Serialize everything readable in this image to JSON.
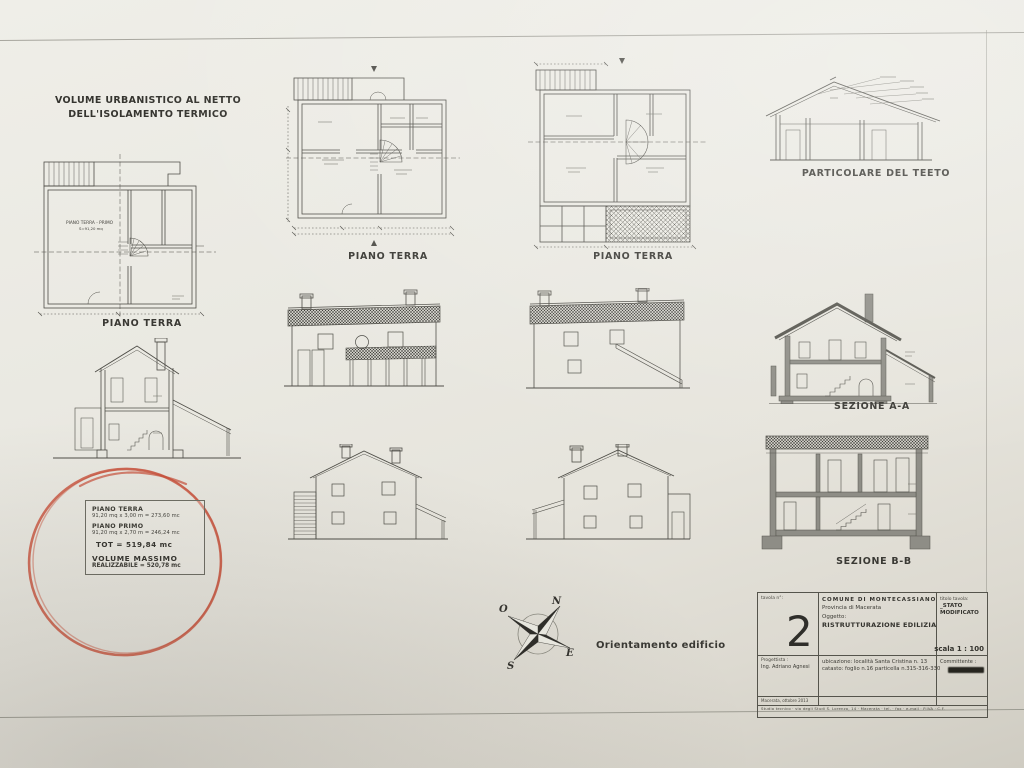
{
  "sheet": {
    "heading_line1": "VOLUME URBANISTICO AL NETTO",
    "heading_line2": "DELL'ISOLAMENTO TERMICO",
    "orientation_label": "Orientamento edificio"
  },
  "drawings": {
    "plan1": {
      "caption": "PIANO TERRA",
      "label1": "PIANO TERRA - PRIMO",
      "label2": "S=91,20 mq"
    },
    "plan2": {
      "caption": "PIANO TERRA"
    },
    "plan3": {
      "caption": "PIANO TERRA"
    },
    "roof_detail": {
      "caption": "PARTICOLARE DEL TEETO"
    },
    "section_a": {
      "caption": "SEZIONE A-A"
    },
    "section_b": {
      "caption": "SEZIONE B-B"
    }
  },
  "volume_note": {
    "piano_terra_label": "PIANO TERRA",
    "piano_terra_calc": "91,20 mq x 3,00 m = 273,60 mc",
    "piano_primo_label": "PIANO PRIMO",
    "piano_primo_calc": "91,20 mq x 2,70 m = 246,24 mc",
    "total": "TOT = 519,84 mc",
    "max_label": "VOLUME MASSIMO",
    "max_value": "REALIZZABILE = 520,78 mc"
  },
  "compass": {
    "north": "N",
    "east": "E",
    "south": "S",
    "west": "O"
  },
  "title_block": {
    "tavola_label": "tavola n°:",
    "tavola_number": "2",
    "comune": "COMUNE DI MONTECASSIANO",
    "provincia": "Provincia di Macerata",
    "oggetto_label": "Oggetto:",
    "oggetto_value": "RISTRUTTURAZIONE EDILIZIA",
    "titolo_label": "titolo tavola:",
    "titolo_value": "_STATO MODIFICATO",
    "scala": "scala 1 : 100",
    "progettista_label": "Progettista :",
    "progettista_value": "Ing. Adriano Agnesi",
    "ubicazione": "ubicazione: località Santa Cristina n. 13",
    "catasto": "catasto: foglio n.16 particella n.315-316-330",
    "committente_label": "Committente :",
    "footer_date": "Macerata, ottobre 2013",
    "footer_studio": "Studio tecnico · via degli Studi S. Lorenzo, 14 · Macerata · tel. · fax · e-mail · P.IVA · C.F."
  },
  "colors": {
    "pen_red": "#c8503a",
    "ink": "#4e4d47",
    "paper": "#e9e8e1"
  }
}
